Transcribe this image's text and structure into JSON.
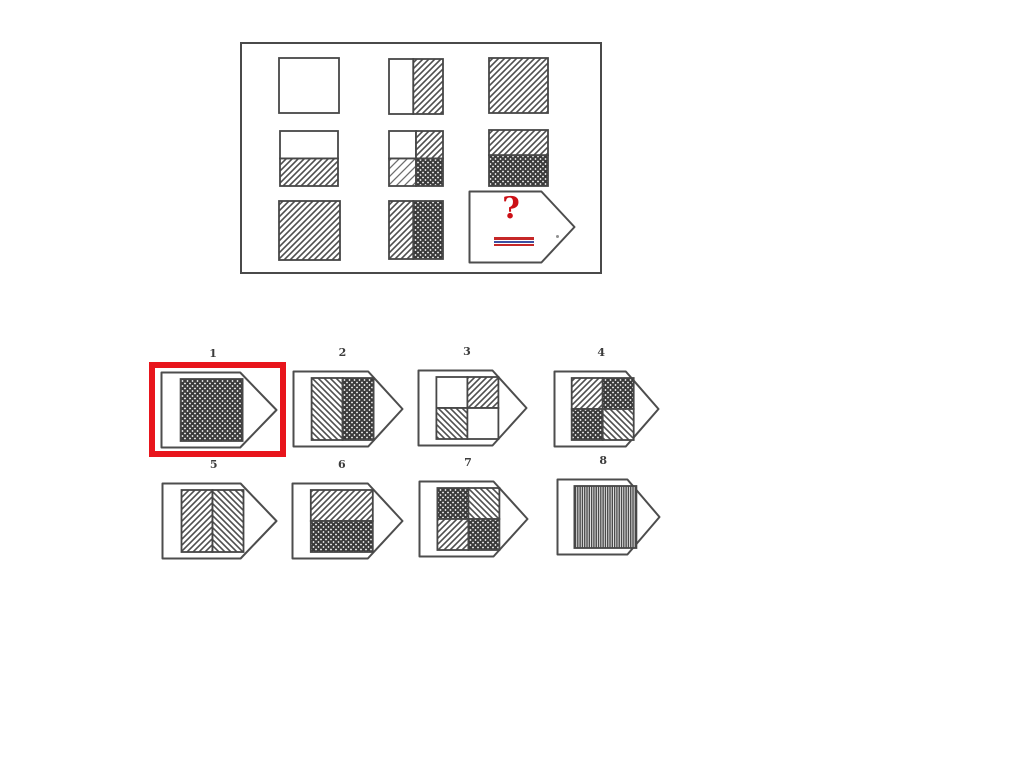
{
  "colors": {
    "ink": "#474747",
    "highlight": "#e8151c",
    "question_mark": "#cc1016",
    "underline": [
      "#c62828",
      "#3d4fa1",
      "#c62828"
    ]
  },
  "matrix": {
    "rows": 3,
    "cols": 3,
    "cells": [
      {
        "id": "r1c1",
        "split": "none",
        "fills": [
          "white"
        ]
      },
      {
        "id": "r1c2",
        "split": "vertical",
        "ratio": 0.45,
        "fills": [
          "white",
          "hatch"
        ]
      },
      {
        "id": "r1c3",
        "split": "none",
        "fills": [
          "hatch"
        ]
      },
      {
        "id": "r2c1",
        "split": "horizontal",
        "ratio": 0.5,
        "fills": [
          "white",
          "hatch"
        ]
      },
      {
        "id": "r2c2",
        "split": "quad",
        "fills": [
          "white",
          "hatch",
          "hatch-light",
          "cross"
        ]
      },
      {
        "id": "r2c3",
        "split": "horizontal",
        "ratio": 0.45,
        "fills": [
          "hatch",
          "cross"
        ]
      },
      {
        "id": "r3c1",
        "split": "none",
        "fills": [
          "hatch"
        ]
      },
      {
        "id": "r3c2",
        "split": "vertical",
        "ratio": 0.45,
        "fills": [
          "hatch",
          "cross"
        ]
      }
    ]
  },
  "question": {
    "mark": "?"
  },
  "options": [
    {
      "number": "1",
      "selected": true,
      "split": "none",
      "fills": [
        "cross"
      ]
    },
    {
      "number": "2",
      "selected": false,
      "split": "vertical",
      "fills": [
        "hatch-back",
        "cross"
      ]
    },
    {
      "number": "3",
      "selected": false,
      "split": "quad",
      "fills": [
        "white",
        "hatch",
        "hatch-back",
        "white"
      ]
    },
    {
      "number": "4",
      "selected": false,
      "split": "quad",
      "fills": [
        "hatch",
        "cross",
        "cross",
        "hatch-back"
      ]
    },
    {
      "number": "5",
      "selected": false,
      "split": "vertical",
      "fills": [
        "hatch",
        "hatch-back"
      ]
    },
    {
      "number": "6",
      "selected": false,
      "split": "horizontal",
      "fills": [
        "hatch",
        "cross"
      ]
    },
    {
      "number": "7",
      "selected": false,
      "split": "quad",
      "fills": [
        "cross",
        "hatch-back",
        "hatch",
        "cross"
      ]
    },
    {
      "number": "8",
      "selected": false,
      "split": "none",
      "fills": [
        "vlines"
      ]
    }
  ],
  "selected_option": "1",
  "pattern_legend": {
    "white": "empty / blank",
    "hatch": "diagonal hatching (/)",
    "hatch-back": "diagonal hatching (\\)",
    "hatch-light": "light sparse diagonal hatching",
    "cross": "dense dark crosshatch",
    "vlines": "vertical line fill"
  }
}
